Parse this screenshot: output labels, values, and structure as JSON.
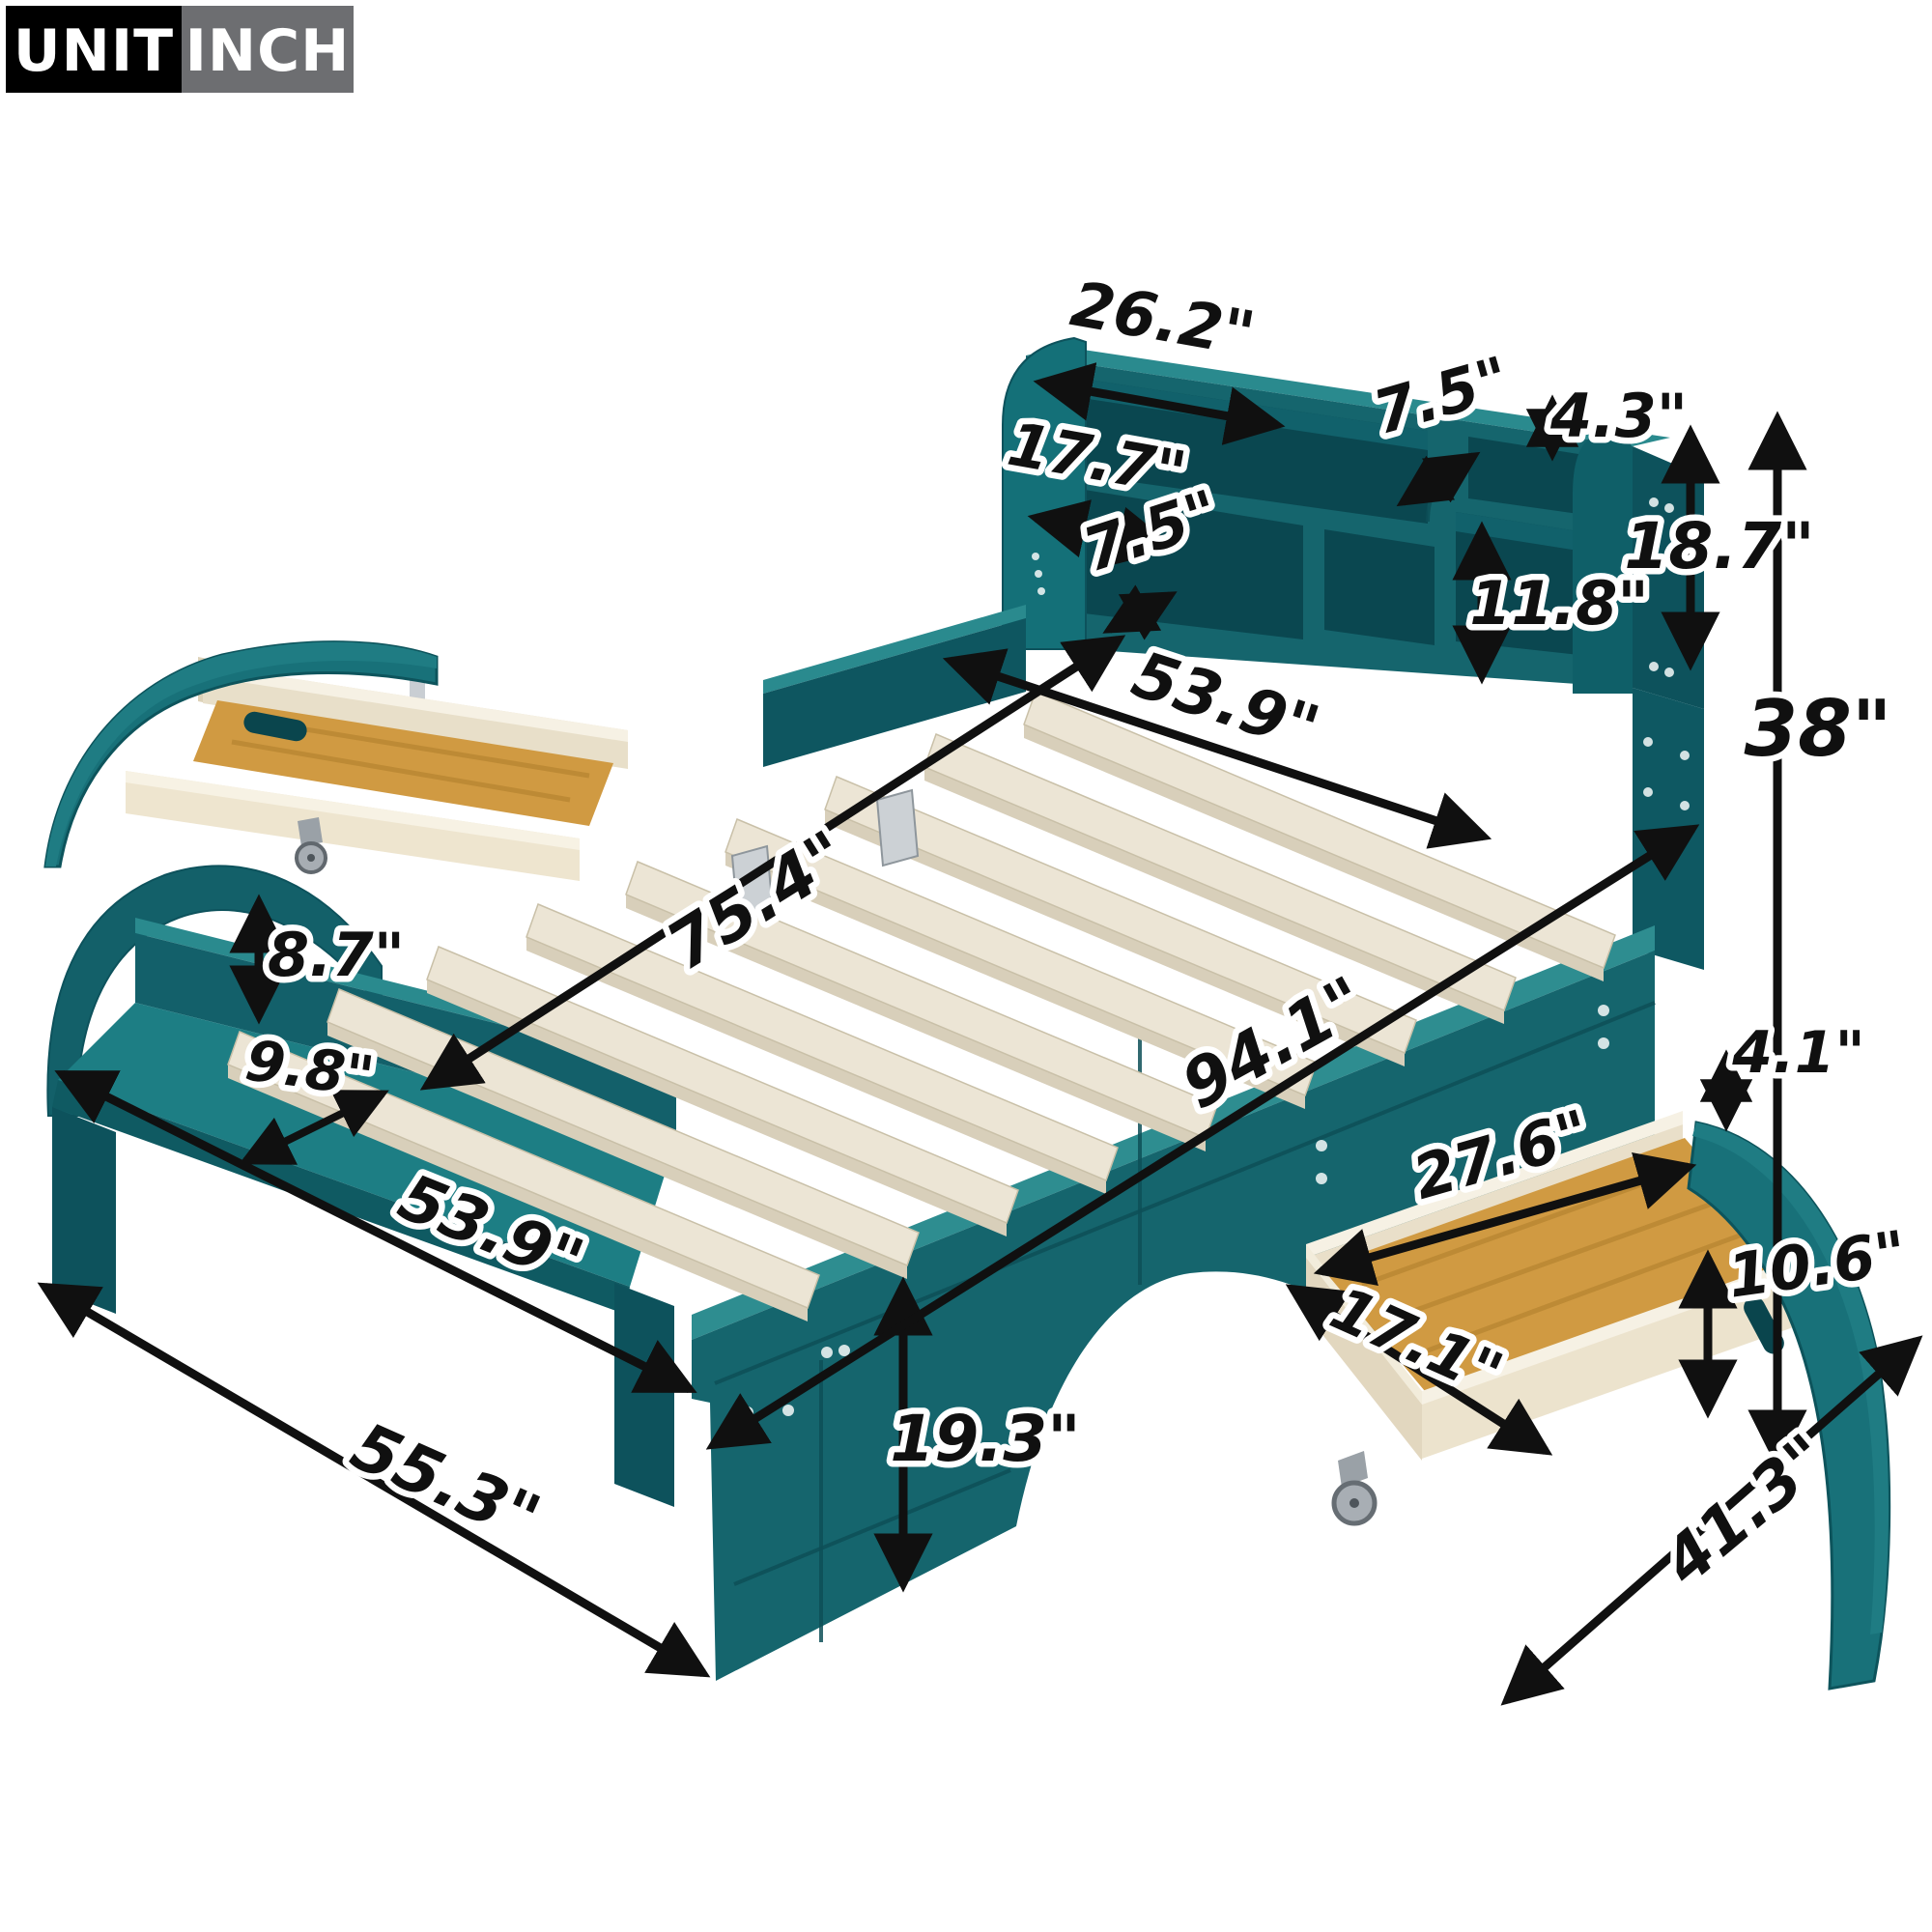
{
  "page": {
    "background": "#ffffff",
    "description": "Product dimension diagram of a teal car-shaped platform bed with bookcase headboard, slatted deck, footboard bench shelf and two rolling under-bed storage drawers",
    "unit": "INCH"
  },
  "unit_badge": {
    "unit_label": "UNIT",
    "inch_label": "INCH"
  },
  "colors": {
    "teal_front": "#15656d",
    "teal_top": "#2a8a8e",
    "teal_dark": "#0d525c",
    "teal_opening": "#0a4750",
    "slat_wood": "#ece5d5",
    "slat_edge": "#d8cfba",
    "plywood": "#e9dfc9",
    "drawer_floor_wood": "#d09a42",
    "arrow_black": "#101010",
    "badge_black": "#000000",
    "badge_gray": "#6d6e71"
  },
  "dims": [
    {
      "id": "headboard-shelf-width",
      "part": "headboard top shelf opening width",
      "value": "26.2\""
    },
    {
      "id": "headboard-top-cubby-width",
      "part": "headboard top right cubby width",
      "value": "7.5\""
    },
    {
      "id": "headboard-top-cubby-height",
      "part": "headboard top right cubby height",
      "value": "4.3\""
    },
    {
      "id": "headboard-left-cubby-width",
      "part": "headboard lower left cubby width",
      "value": "17.7\""
    },
    {
      "id": "headboard-mid-cubby-width",
      "part": "headboard lower middle cubby width",
      "value": "7.5\""
    },
    {
      "id": "headboard-right-cubby-height",
      "part": "headboard right cubby height",
      "value": "11.8\""
    },
    {
      "id": "bookcase-height",
      "part": "bookcase headboard height",
      "value": "18.7\""
    },
    {
      "id": "total-height",
      "part": "overall headboard height",
      "value": "38\""
    },
    {
      "id": "deck-width-top",
      "part": "slat deck width at head",
      "value": "53.9\""
    },
    {
      "id": "slat-area-length",
      "part": "slat deck length",
      "value": "75.4\""
    },
    {
      "id": "shelf-to-deck-height",
      "part": "footboard shelf to deck height",
      "value": "8.7\""
    },
    {
      "id": "footboard-shelf-depth",
      "part": "footboard shelf depth",
      "value": "9.8\""
    },
    {
      "id": "footboard-shelf-width",
      "part": "footboard shelf width",
      "value": "53.9\""
    },
    {
      "id": "overall-width",
      "part": "overall width at foot",
      "value": "55.3\""
    },
    {
      "id": "side-rail-height",
      "part": "side rail height",
      "value": "19.3\""
    },
    {
      "id": "overall-length",
      "part": "overall bed length",
      "value": "94.1\""
    },
    {
      "id": "drawer-side-height",
      "part": "storage drawer box side height",
      "value": "4.1\""
    },
    {
      "id": "drawer-inner-length",
      "part": "storage drawer interior length",
      "value": "27.6\""
    },
    {
      "id": "drawer-inner-width",
      "part": "storage drawer interior width",
      "value": "17.1\""
    },
    {
      "id": "drawer-panel-height",
      "part": "storage drawer curved panel height",
      "value": "10.6\""
    },
    {
      "id": "drawer-overall-length",
      "part": "storage drawer overall length",
      "value": "41.3\""
    }
  ]
}
